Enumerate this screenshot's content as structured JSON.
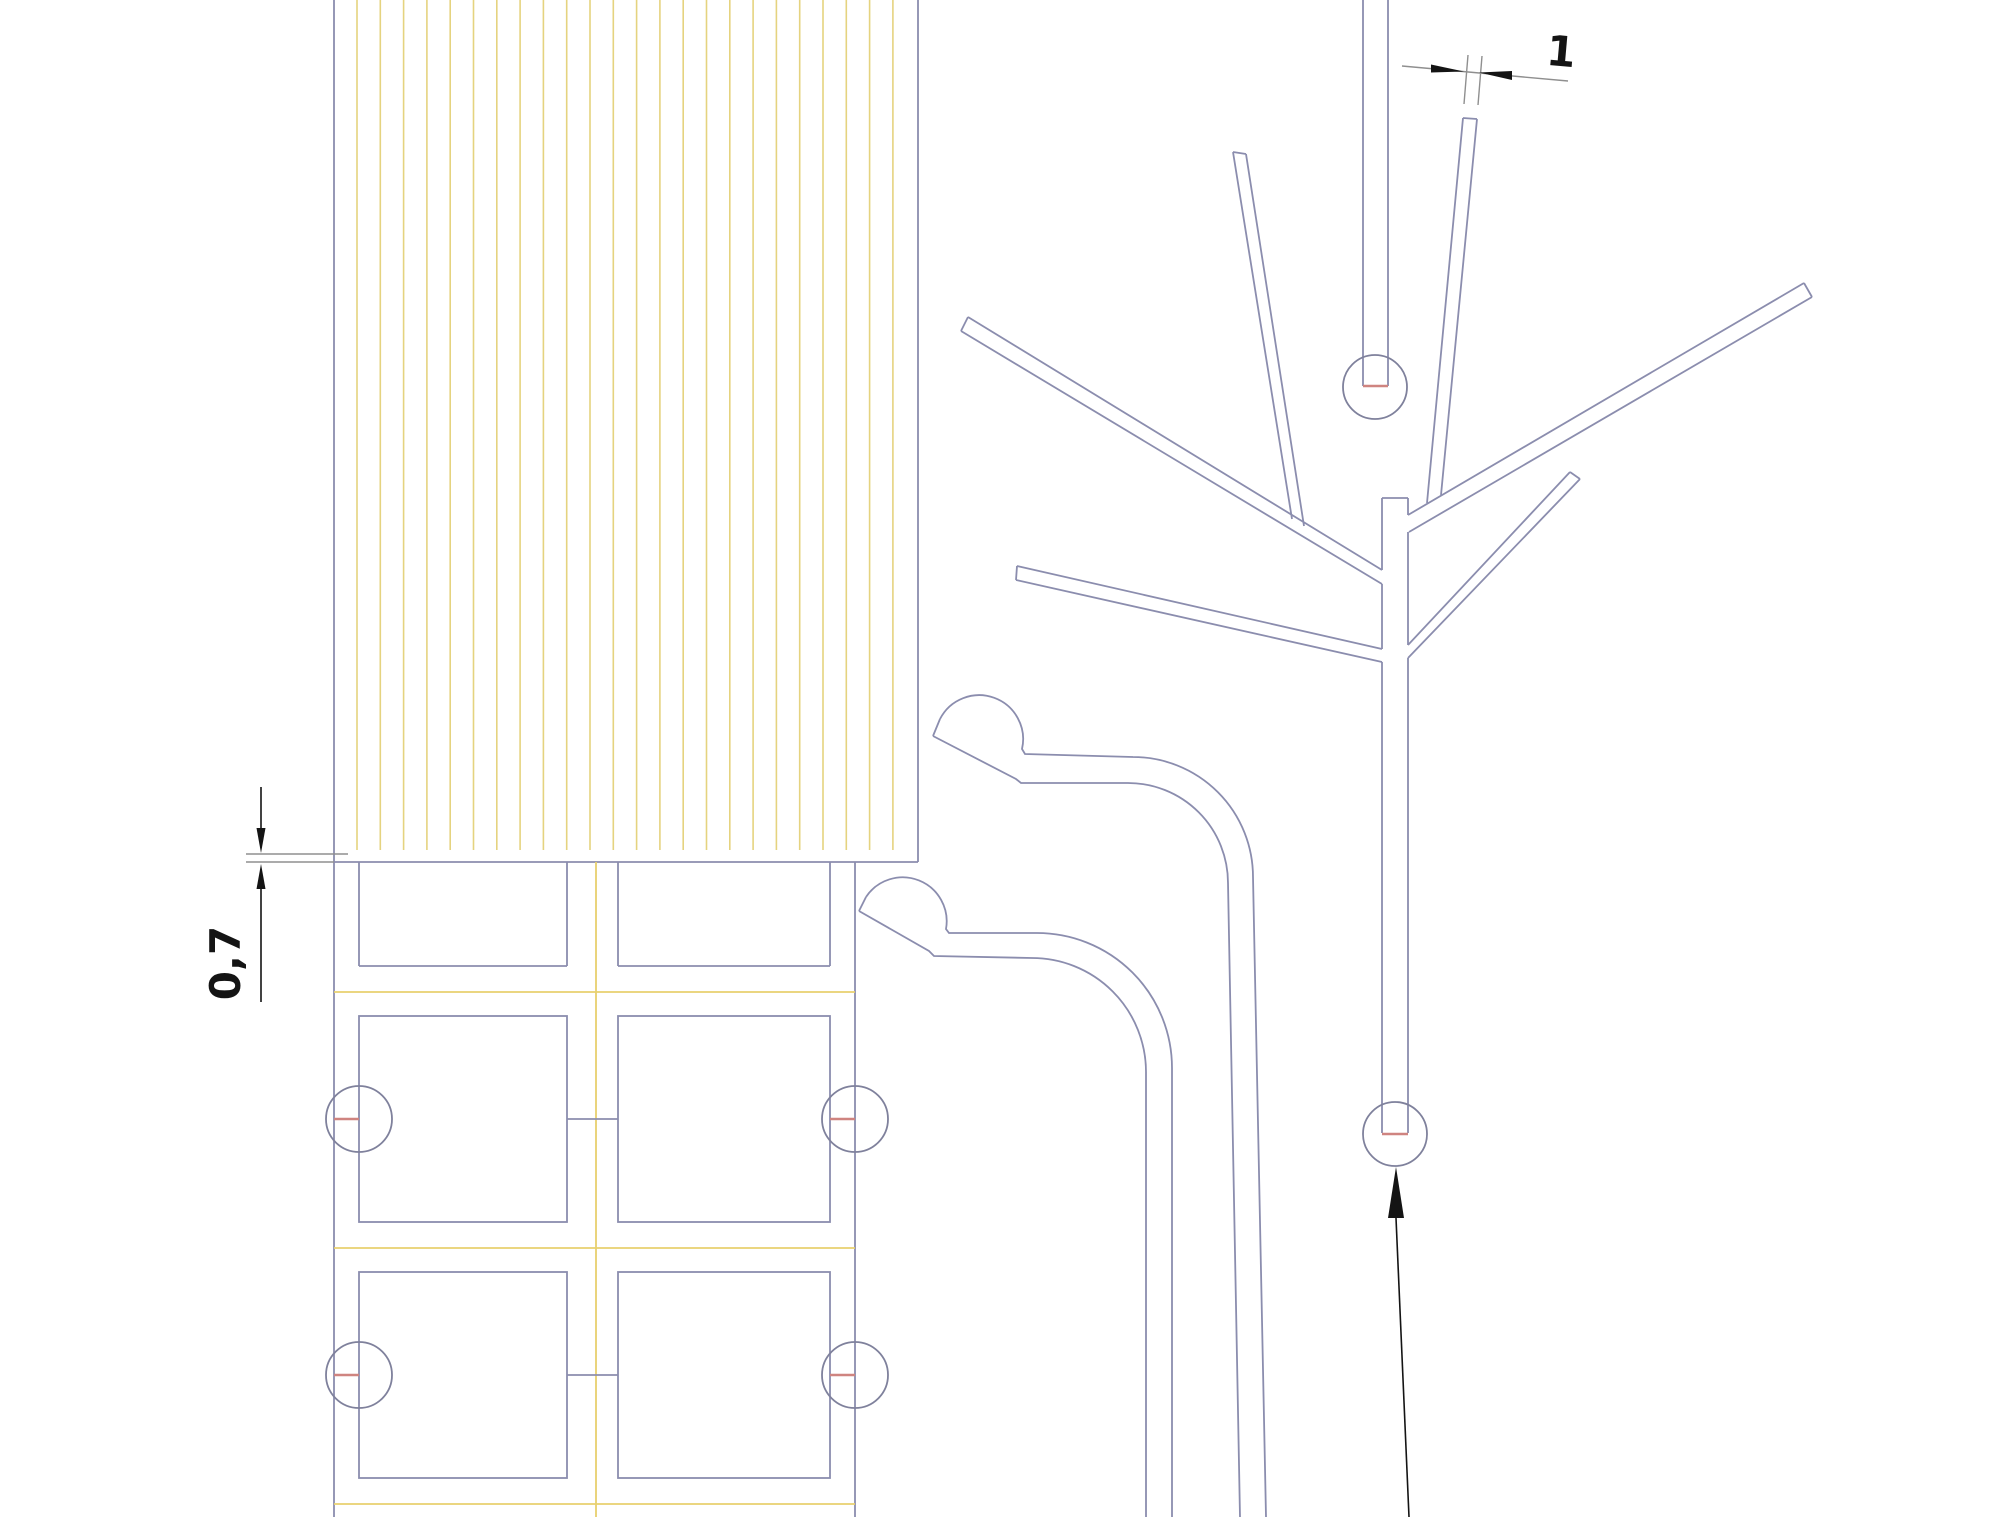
{
  "drawing": {
    "colors": {
      "bg": "#ffffff",
      "line_color": "#8b8dae",
      "circle_color": "#7f819c",
      "hatch_color": "#e5d37f",
      "separator_color": "#e8d06e",
      "marker_color": "#cf8480",
      "dim_color": "#141414",
      "dim_line_color": "#8f8f8f"
    },
    "dimensions": {
      "channel_width": {
        "label": "1"
      },
      "overlap": {
        "label": "0,7"
      }
    },
    "hatch": {
      "count": 24,
      "x_start": 357,
      "step": 23.3,
      "y_top": 0,
      "y_bottom": 850
    },
    "grid": {
      "left_boundary_x": 334,
      "right_boundary_x": 855,
      "center_line_x": 596,
      "top_y": 862,
      "bottom_y": 1517,
      "circle_radius": 33,
      "col1": {
        "left": 359,
        "right": 567
      },
      "col2": {
        "left": 618,
        "right": 830
      },
      "separators_y": [
        992,
        1248,
        1504
      ],
      "rows": [
        {
          "type": "partial",
          "y_top": 862,
          "y_bottom": 966
        },
        {
          "type": "full",
          "y_top": 1016,
          "y_bottom": 1222,
          "center_y": 1119
        },
        {
          "type": "full",
          "y_top": 1272,
          "y_bottom": 1478,
          "center_y": 1375
        }
      ]
    }
  }
}
